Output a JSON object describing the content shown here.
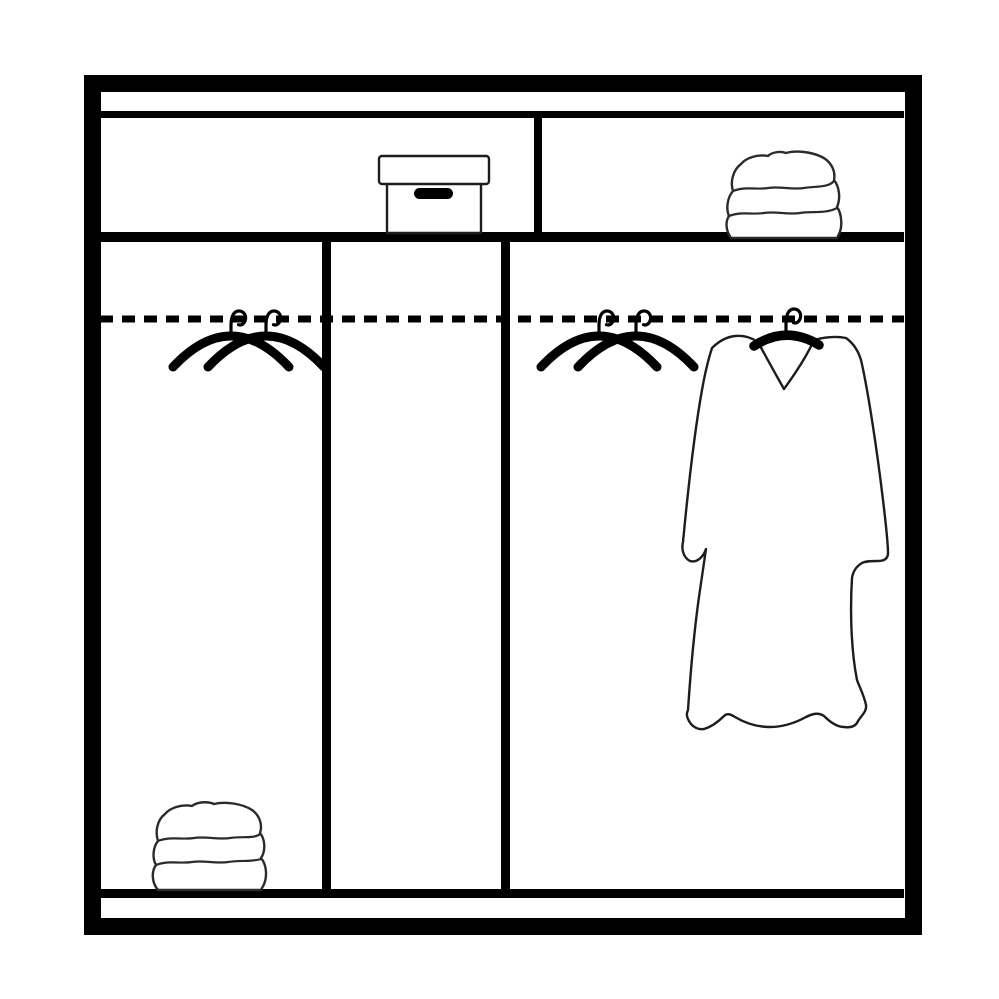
{
  "colors": {
    "line": "#000000",
    "sketch_line": "#1d1d1d",
    "soft_line": "#2b2b2b",
    "background": "#ffffff"
  },
  "diagram": {
    "type": "line-drawing",
    "subject": "wardrobe-interior-storage-schematic",
    "text_labels": [],
    "objects": [
      {
        "name": "wardrobe-frame",
        "kind": "cabinet-outline",
        "bbox": [
          84,
          75,
          922,
          935
        ]
      },
      {
        "name": "top-panel-strip",
        "kind": "frame-rail",
        "bbox": [
          100,
          91,
          904,
          118
        ]
      },
      {
        "name": "top-shelf-board",
        "kind": "shelf",
        "bbox": [
          100,
          232,
          904,
          242
        ]
      },
      {
        "name": "top-shelf-divider",
        "kind": "divider",
        "bbox": [
          534,
          118,
          542,
          232
        ]
      },
      {
        "name": "storage-box",
        "kind": "lidded-box-with-handle-slot",
        "bbox": [
          379,
          156,
          489,
          233
        ],
        "shelf": "top-left"
      },
      {
        "name": "folded-linen-stack-top",
        "kind": "three-folded-towels",
        "bbox": [
          725,
          152,
          843,
          238
        ],
        "shelf": "top-right"
      },
      {
        "name": "left-compartment-divider",
        "kind": "divider",
        "bbox": [
          322,
          242,
          331,
          889
        ]
      },
      {
        "name": "right-compartment-divider",
        "kind": "divider",
        "bbox": [
          501,
          242,
          510,
          889
        ]
      },
      {
        "name": "hanging-rail",
        "kind": "dashed-rod",
        "y": 319,
        "x_span": [
          100,
          904
        ]
      },
      {
        "name": "clothes-hangers-left",
        "kind": "wire-hangers",
        "count": 2,
        "hook_x": [
          231,
          266
        ],
        "rail_y": 319
      },
      {
        "name": "clothes-hangers-right",
        "kind": "wire-hangers",
        "count": 2,
        "hook_x": [
          599,
          636
        ],
        "rail_y": 319
      },
      {
        "name": "hanging-garment",
        "kind": "robe-on-hanger",
        "bbox": [
          682,
          308,
          889,
          730
        ]
      },
      {
        "name": "folded-linen-stack-bottom",
        "kind": "three-folded-towels",
        "bbox": [
          151,
          801,
          268,
          890
        ],
        "shelf": "bottom-left"
      },
      {
        "name": "bottom-board",
        "kind": "shelf",
        "bbox": [
          100,
          889,
          904,
          898
        ]
      },
      {
        "name": "base-plinth",
        "kind": "frame-rail",
        "bbox": [
          100,
          898,
          904,
          921
        ]
      }
    ],
    "compartments": [
      {
        "name": "left-compartment",
        "contents": [
          "clothes-hangers-left",
          "folded-linen-stack-bottom"
        ]
      },
      {
        "name": "middle-compartment",
        "contents": []
      },
      {
        "name": "right-compartment",
        "contents": [
          "clothes-hangers-right",
          "hanging-garment"
        ]
      }
    ]
  }
}
